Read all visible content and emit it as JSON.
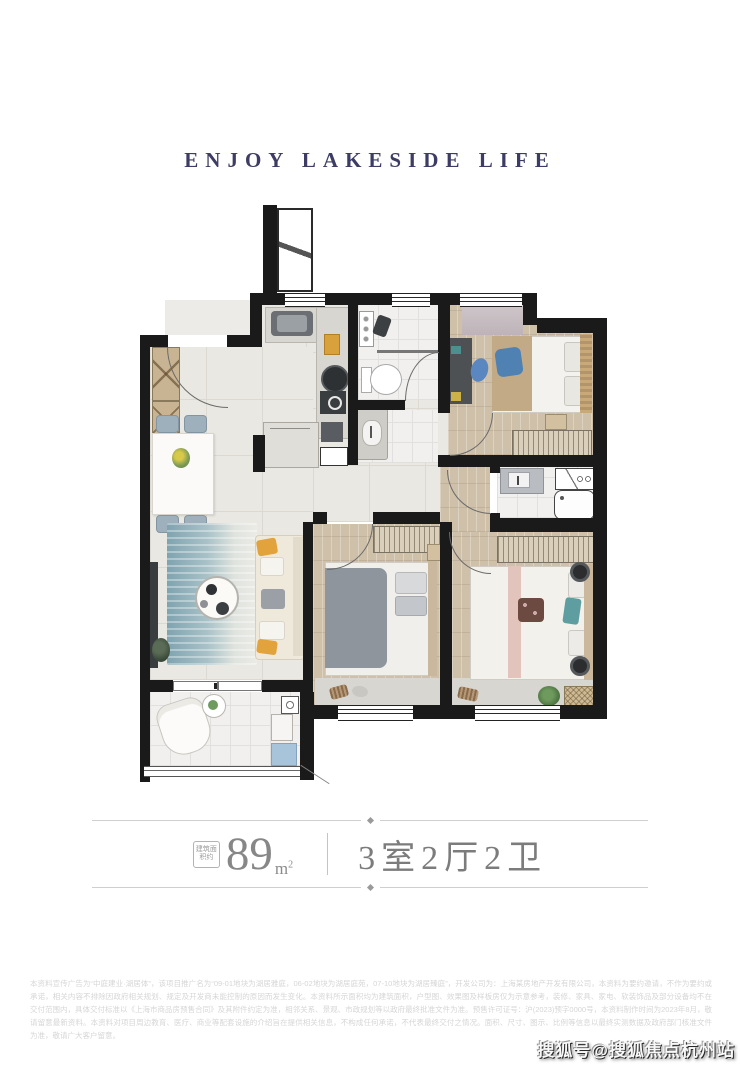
{
  "header": {
    "title": "ENJOY LAKESIDE LIFE"
  },
  "floorplan": {
    "description": "apartment floor plan, 3 bedrooms 2 living rooms 2 bathrooms",
    "rooms": [
      "entry",
      "kitchen",
      "bathroom",
      "dining",
      "living-room",
      "bedroom",
      "master-bathroom",
      "master-bedroom",
      "second-bedroom",
      "balcony",
      "flue-shaft",
      "corridor"
    ],
    "wall_color": "#1a1a1a",
    "wood_color": "#cfc0aa",
    "tile_color": "#eae8e2",
    "rug_color": "#7fa3b0"
  },
  "spec": {
    "seal_text": "建筑面积约",
    "area_value": "89",
    "area_unit_base": "m",
    "area_unit_sup": "2",
    "layout_text": "3室2厅2卫"
  },
  "disclaimer": {
    "text": "本资料宣传广告为“中庭建业·湖居体”，该项目推广名为“09-01地块为湖居雅庭，06-02地块为湖居庭苑，07-10地块为湖居臻庭”，开发公司为：上海某房地产开发有限公司，本资料为要约邀请，不作为要约或承诺，相关内容不排除因政府相关规划、规定及开发商未能控制的原因而发生变化。本资料所示面积均为建筑面积，户型图、效果图及样板房仅为示意参考，装修、家具、家电、软装饰品及部分设备均不在交付范围内，具体交付标准以《上海市商品房预售合同》及其附件约定为准，相邻关系、景观、市政规划等以政府最终批准文件为准。预售许可证号：沪(2023)预字0000号，本资料制作时间为2023年8月，敬请留意最新资料。本资料对项目周边教育、医疗、商业等配套设施的介绍旨在提供相关信息，不构成任何承诺，不代表最终交付之情况。面积、尺寸、图示、比例等信息以最终实测数据及政府部门核准文件为准，敬请广大客户留意。"
  },
  "watermark": {
    "text": "搜狐号@搜狐焦点杭州站"
  }
}
